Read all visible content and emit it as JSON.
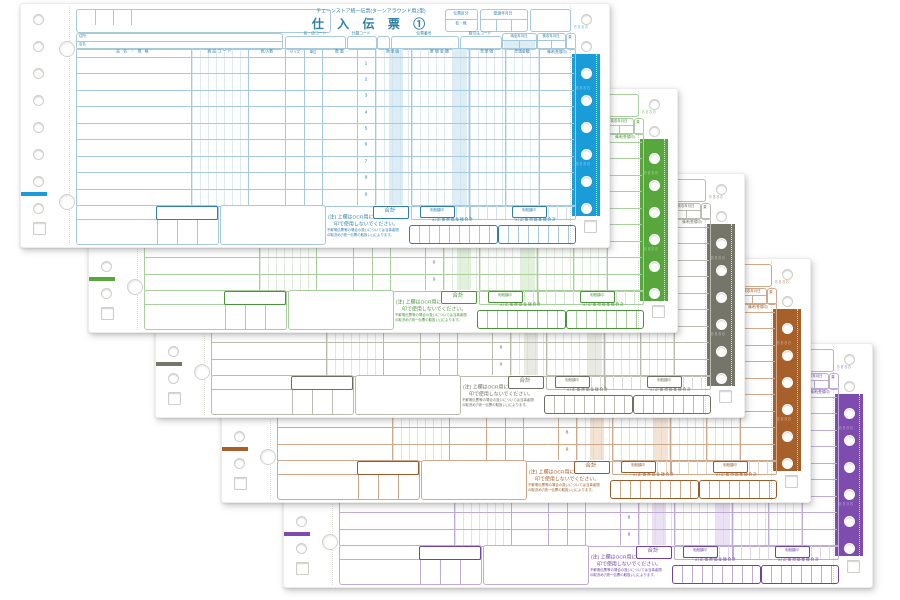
{
  "form": {
    "header": {
      "series_title": "チェーンストア統一伝票(ターンアラウンド用2型)",
      "main_title": "仕 入 伝 票 ①",
      "slip_class_label": "伝票区分",
      "slip_class_values": "有・無",
      "handover_date_label": "受渡年月日",
      "address_label": "住所",
      "store_label": "店名",
      "store_code_label": "店・店コード",
      "category_code_label": "分類コード",
      "slip_number_label": "伝票番号",
      "vendor_code_label": "取引先コード",
      "delivery_date_label": "納品年月日",
      "inspection_date_label": "検収年月日",
      "page_label": "頁",
      "month_label": "月",
      "day_label": "日"
    },
    "table": {
      "columns": [
        "品名・規格",
        "商品コード",
        "色/入数",
        "サイズ",
        "単位",
        "数量",
        "",
        "原単価",
        "原価金額",
        "売単価",
        "売価金額",
        "備考(受領印)"
      ],
      "row_numbers": [
        "1",
        "2",
        "3",
        "4",
        "5",
        "6",
        "7",
        "8",
        "9"
      ]
    },
    "footer": {
      "total_label": "合計",
      "offset_tag_label": "相殺額印",
      "cost_total_label": "訂正後原価金額合計",
      "price_total_label": "訂正後売価金額合計",
      "note_line1": "(注) 上欄はOCR用につき朱肉",
      "note_line2": "印で使用しないでください。",
      "note_small_line1": "不鮮明伝票等の場合の扱いについては当事者間",
      "note_small_line2": "の取決め(「統一伝票の取扱い」)によります。"
    },
    "margin_digits": "8888"
  },
  "copies": [
    {
      "name": "copy-1-cyan",
      "strip": "#199CD8",
      "ink": "#A6C9DB",
      "ink_strong": "#2F7FA9",
      "shade": "#DCEDF6",
      "faint": "#CFE3EF",
      "left": 20,
      "top": 3
    },
    {
      "name": "copy-2-green",
      "strip": "#58A73C",
      "ink": "#A9CF9E",
      "ink_strong": "#49943B",
      "shade": "#E2F0DC",
      "faint": "#D4E8CD",
      "left": 88,
      "top": 88
    },
    {
      "name": "copy-3-gray",
      "strip": "#757569",
      "ink": "#BBBBB1",
      "ink_strong": "#6E6E63",
      "shade": "#EAEAE4",
      "faint": "#DCDCD5",
      "left": 155,
      "top": 173
    },
    {
      "name": "copy-4-brown",
      "strip": "#A8602B",
      "ink": "#D0A98C",
      "ink_strong": "#9B5B28",
      "shade": "#F2E3D5",
      "faint": "#E8D4C2",
      "left": 221,
      "top": 258
    },
    {
      "name": "copy-5-purple",
      "strip": "#7E4BAE",
      "ink": "#BFABD8",
      "ink_strong": "#6F42A5",
      "shade": "#EAE2F4",
      "faint": "#DFD3ED",
      "left": 283,
      "top": 343
    }
  ]
}
